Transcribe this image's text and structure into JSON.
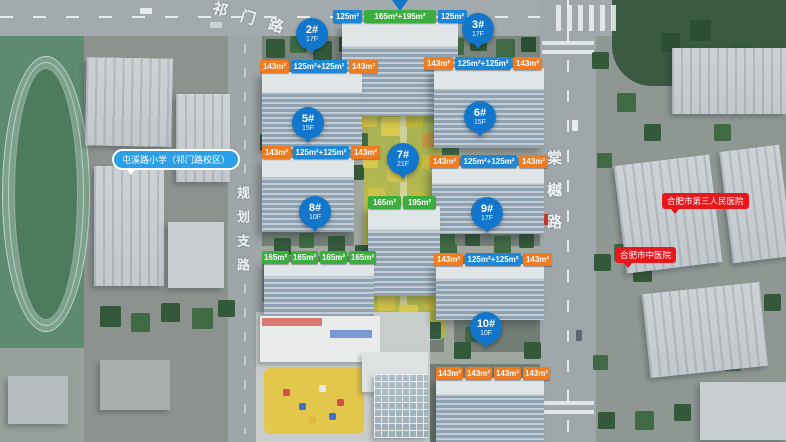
{
  "site": {
    "roads": {
      "top": "祁门路",
      "left": "规划支路",
      "right": "棠樾路"
    },
    "pois": {
      "school": "屯溪路小学（祁门路校区）",
      "hospital_third": "合肥市第三人民医院",
      "hospital_tcm": "合肥市中医院"
    },
    "colors": {
      "pin_blue": "#1276cb",
      "chip_orange": "#ef7b22",
      "chip_blue": "#1e86d6",
      "chip_green": "#3cae3f",
      "poi_red": "#e8161d",
      "poi_blue": "#2ba0e8"
    }
  },
  "buildings": {
    "b1": {
      "units": [
        {
          "area": "125m²",
          "type": "blue"
        },
        {
          "area": "165m²+195m²",
          "type": "green"
        },
        {
          "area": "125m²",
          "type": "blue"
        }
      ]
    },
    "b2": {
      "pin": "2#",
      "floors": "17F",
      "units": [
        {
          "area": "143m²",
          "type": "orange"
        },
        {
          "area": "125m²+125m²",
          "type": "blue"
        },
        {
          "area": "143m²",
          "type": "orange"
        }
      ]
    },
    "b3": {
      "pin": "3#",
      "floors": "17F",
      "units": [
        {
          "area": "143m²",
          "type": "orange"
        },
        {
          "area": "125m²+125m²",
          "type": "blue"
        },
        {
          "area": "143m²",
          "type": "orange"
        }
      ]
    },
    "b5": {
      "pin": "5#",
      "floors": "15F",
      "units": [
        {
          "area": "143m²",
          "type": "orange"
        },
        {
          "area": "125m²+125m²",
          "type": "blue"
        },
        {
          "area": "143m²",
          "type": "orange"
        }
      ]
    },
    "b6": {
      "pin": "6#",
      "floors": "15F",
      "units": [
        {
          "area": "143m²",
          "type": "orange"
        },
        {
          "area": "125m²+125m²",
          "type": "blue"
        },
        {
          "area": "143m²",
          "type": "orange"
        }
      ]
    },
    "b7": {
      "pin": "7#",
      "floors": "21F",
      "units": [
        {
          "area": "165m²",
          "type": "green"
        },
        {
          "area": "195m²",
          "type": "green"
        }
      ]
    },
    "b8": {
      "pin": "8#",
      "floors": "10F",
      "units": [
        {
          "area": "165m²",
          "type": "green"
        },
        {
          "area": "165m²",
          "type": "green"
        },
        {
          "area": "165m²",
          "type": "green"
        },
        {
          "area": "165m²",
          "type": "green"
        }
      ]
    },
    "b9": {
      "pin": "9#",
      "floors": "17F",
      "units": [
        {
          "area": "143m²",
          "type": "orange"
        },
        {
          "area": "125m²+125m²",
          "type": "blue"
        },
        {
          "area": "143m²",
          "type": "orange"
        }
      ]
    },
    "b10": {
      "pin": "10#",
      "floors": "10F",
      "units": [
        {
          "area": "143m²",
          "type": "orange"
        },
        {
          "area": "143m²",
          "type": "orange"
        },
        {
          "area": "143m²",
          "type": "orange"
        },
        {
          "area": "143m²",
          "type": "orange"
        }
      ]
    }
  }
}
